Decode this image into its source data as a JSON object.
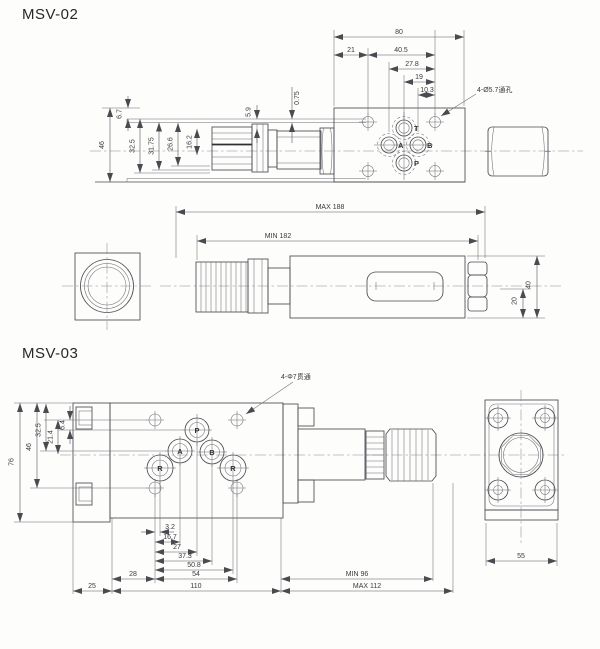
{
  "msv02": {
    "title": "MSV-02",
    "holes_note": "4-Ø5.7通孔",
    "ports": {
      "t": "T",
      "a": "A",
      "b": "B",
      "p": "P"
    },
    "dims": {
      "w80": "80",
      "w21": "21",
      "w405": "40.5",
      "w278": "27.8",
      "w19": "19",
      "w103": "10.3",
      "h46": "46",
      "h325": "32.5",
      "h3175": "31.75",
      "h266": "26.6",
      "h162": "16.2",
      "h59": "5.9",
      "h67": "6.7",
      "h075": "0.75",
      "len_max": "MAX 188",
      "len_min": "MIN 182",
      "h20": "20",
      "h40": "40"
    }
  },
  "msv03": {
    "title": "MSV-03",
    "holes_note": "4-Φ7贯通",
    "ports": {
      "p": "P",
      "a": "A",
      "b": "B",
      "r1": "R",
      "r2": "R"
    },
    "dims": {
      "h76": "76",
      "h46": "46",
      "h325": "32.5",
      "h214": "21.4",
      "h64": "6.4",
      "w32": "3.2",
      "w167": "16.7",
      "w27": "27",
      "w373": "37.3",
      "w508": "50.8",
      "w54": "54",
      "w28": "28",
      "w25": "25",
      "w110": "110",
      "len_min": "MIN 96",
      "len_max": "MAX 112",
      "w55": "55"
    }
  }
}
